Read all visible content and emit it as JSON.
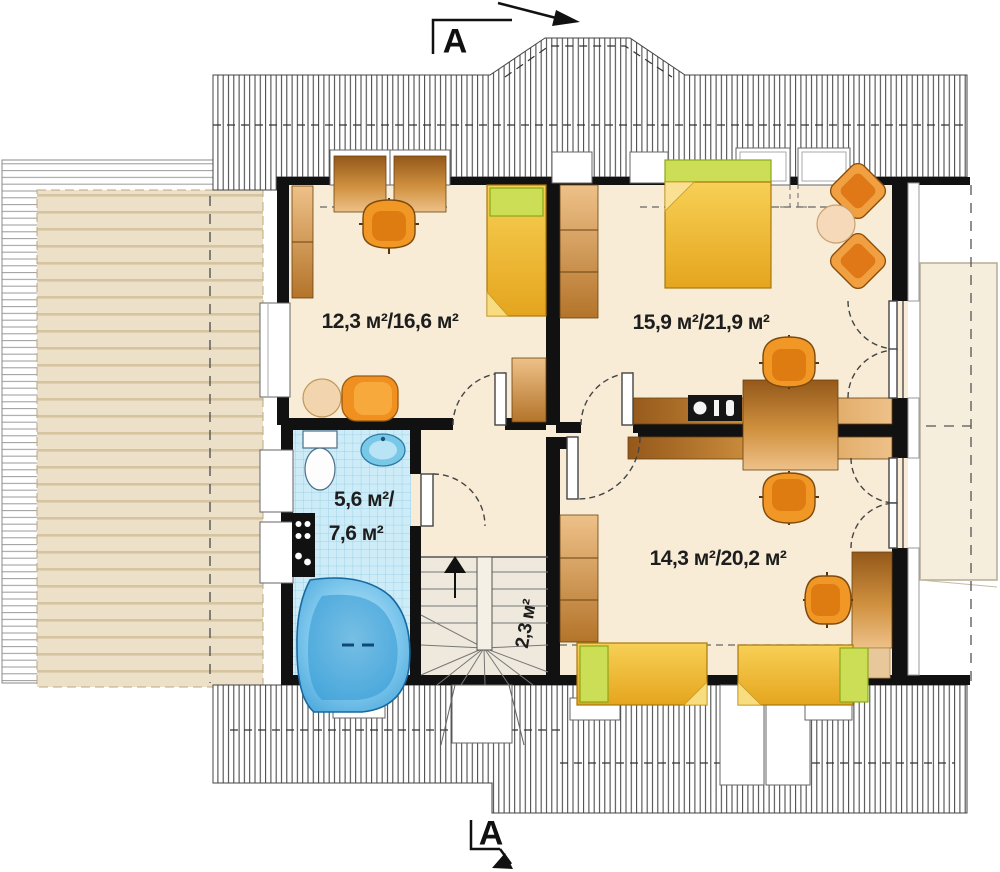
{
  "document": {
    "type": "architectural floor plan (attic storey)",
    "section_marker_top": "A",
    "section_marker_bottom": "A"
  },
  "rooms": [
    {
      "name": "room-top-left",
      "area_label": "12,3 м²/16,6 м²"
    },
    {
      "name": "room-top-right",
      "area_label": "15,9 м²/21,9 м²"
    },
    {
      "name": "bathroom",
      "area_label_line1": "5,6 м²/",
      "area_label_line2": "7,6 м²"
    },
    {
      "name": "room-bottom-right",
      "area_label": "14,3 м²/20,2 м²"
    },
    {
      "name": "staircase",
      "area_label": "2,3 м²"
    }
  ],
  "colors": {
    "floor_cream": "#f8ecd6",
    "wall_black": "#111111",
    "roof_beige": "#ece0c8",
    "bath_tile_blue": "#cdecf8",
    "furniture_wood": "#d99a55",
    "bed_yellow": "#f4c945",
    "pillow_green": "#cbde55",
    "chair_orange": "#ef8f1f",
    "tub_blue": "#5ab8e8"
  }
}
